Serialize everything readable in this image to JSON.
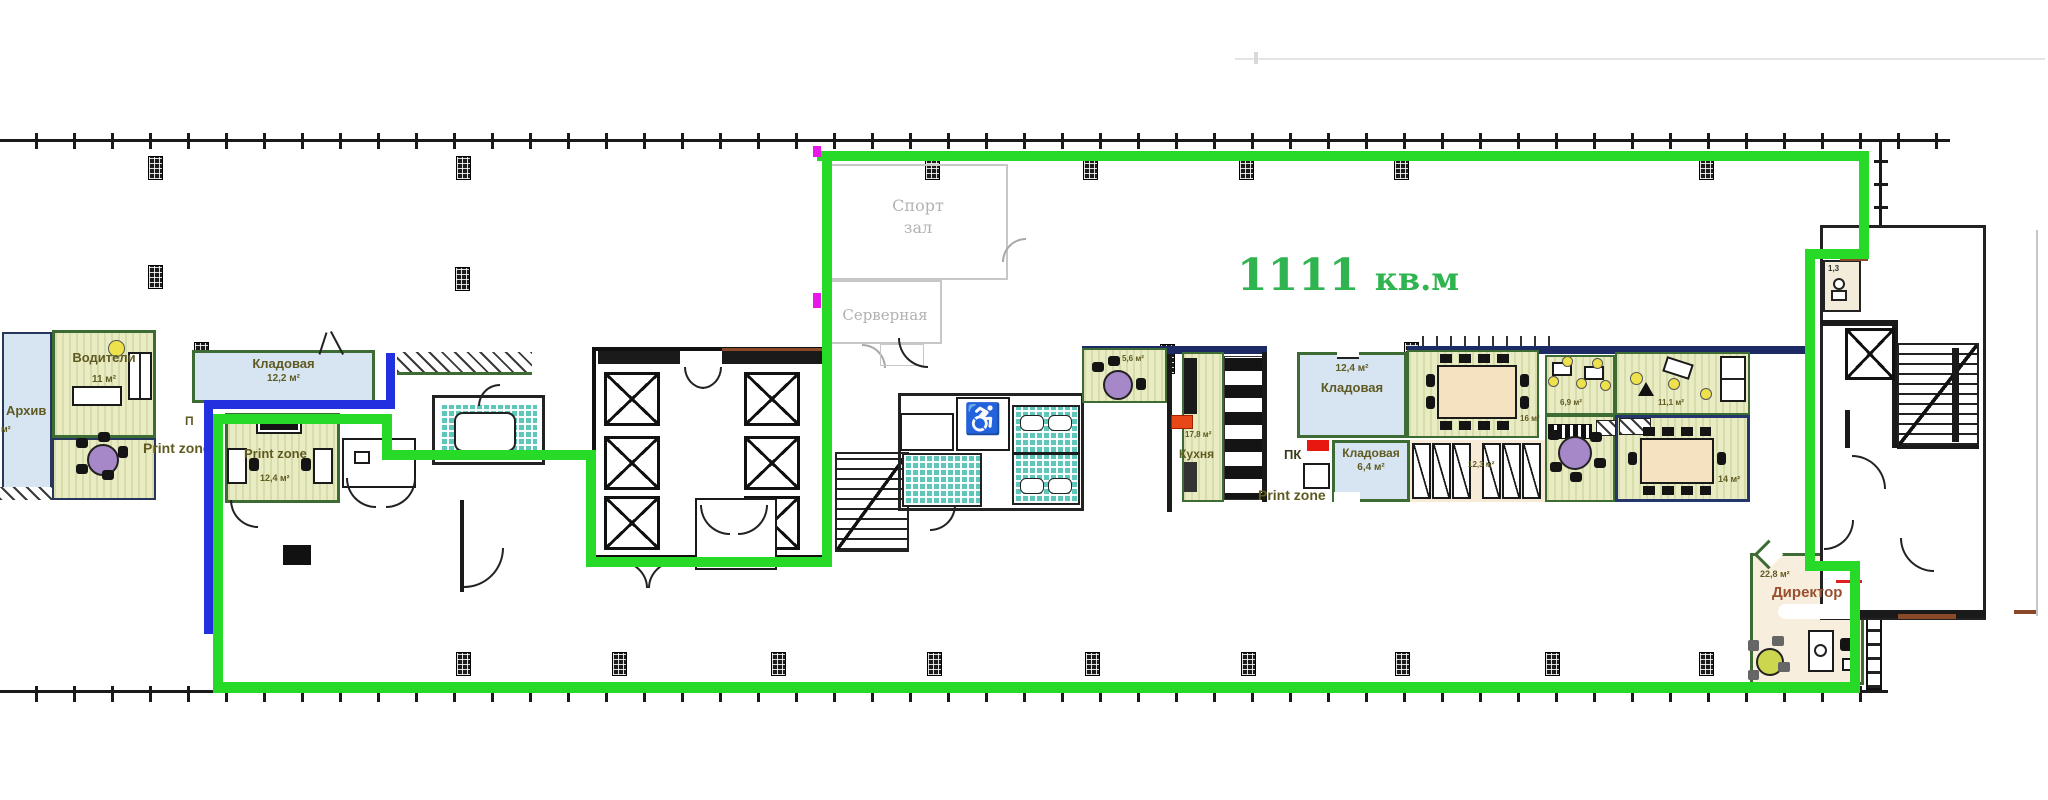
{
  "document": {
    "type": "office floor plan with highlighted lease area",
    "total_area": {
      "value": "1111",
      "unit": "кв.м",
      "full": "1111 кв.м"
    }
  },
  "colors": {
    "lease_outline_green": "#27da27",
    "secondary_outline_blue": "#2330e0",
    "marker_magenta": "#e818e8",
    "area_text_green": "#2fb450",
    "room_fill_olive": "#e9ecc2",
    "room_fill_blue": "#d7e5f2",
    "tile_teal": "#5fc6ba"
  },
  "rooms": {
    "voditeli": {
      "name": "Водители",
      "area": "11 м²"
    },
    "arhiv": {
      "name": "Архив",
      "area_fragment": "м²"
    },
    "kladovaya_122": {
      "name": "Кладовая",
      "area": "12,2 м²"
    },
    "pk_left_fragment": "П",
    "print_zone_left": "Print zone",
    "print_zone_room": {
      "name": "Print zone",
      "area": "12,4 м²"
    },
    "sport_hall": {
      "line1": "Спорт",
      "line2": "зал"
    },
    "server_room": {
      "name": "Серверная"
    },
    "room_56": {
      "area": "5,6 м²"
    },
    "kitchen": {
      "name": "Кухня",
      "area": "17,8 м²"
    },
    "pk_right": "ПК",
    "kladovaya_124": {
      "name": "Кладовая",
      "area": "12,4 м²"
    },
    "kladovaya_64": {
      "name": "Кладовая",
      "area": "6,4 м²"
    },
    "print_zone_right": "Print zone",
    "lockers": {
      "area": "12,3 м²"
    },
    "room_16": {
      "area": "16 м²"
    },
    "room_69": {
      "area": "6,9 м²"
    },
    "room_111": {
      "area": "11,1 м²"
    },
    "room_14": {
      "area": "14 м²"
    },
    "wc_small": {
      "area": "1,3"
    },
    "director": {
      "name": "Директор",
      "area": "22,8 м²"
    }
  },
  "icons": {
    "wheelchair": "♿"
  }
}
